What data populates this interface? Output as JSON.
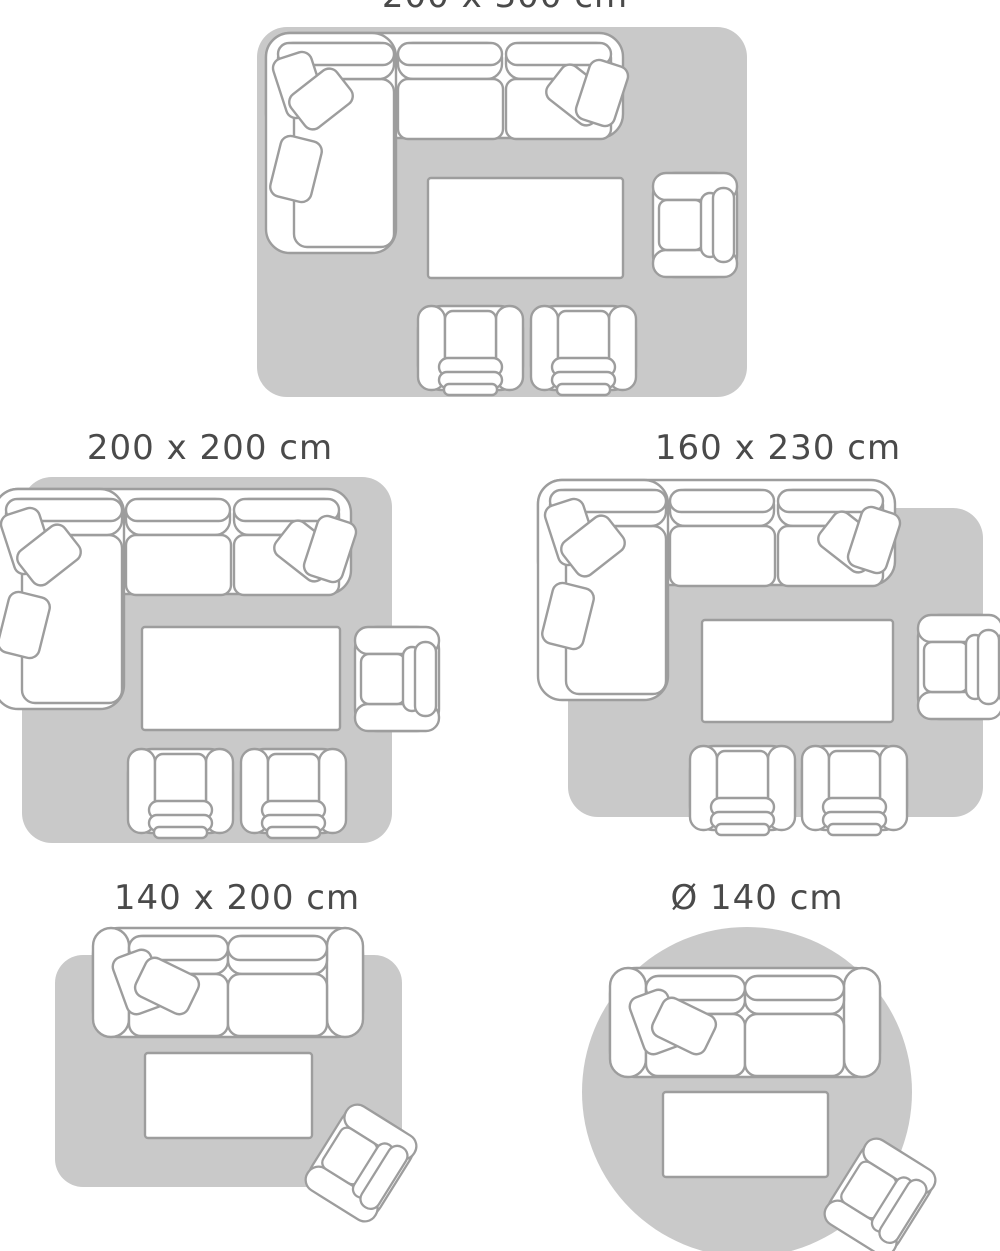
{
  "illustration": {
    "type": "rug-size-guide",
    "description": "Top-view living room furniture arrangements shown on five rug sizes"
  },
  "colors": {
    "background": "#ffffff",
    "rug": "#c9c9c9",
    "outline": "#9d9d9d",
    "furniture_fill": "#ffffff",
    "title": "#4a4a4a"
  },
  "layouts": [
    {
      "id": "200x300",
      "label": "200 x 300 cm",
      "rug_shape": "rectangle",
      "furniture": [
        "sectional-sofa",
        "throw-pillows",
        "coffee-table",
        "armchair",
        "club-chair",
        "club-chair"
      ]
    },
    {
      "id": "200x200",
      "label": "200 x 200 cm",
      "rug_shape": "rectangle",
      "furniture": [
        "sectional-sofa",
        "throw-pillows",
        "coffee-table",
        "armchair",
        "club-chair",
        "club-chair"
      ]
    },
    {
      "id": "160x230",
      "label": "160 x 230 cm",
      "rug_shape": "rectangle",
      "furniture": [
        "sectional-sofa",
        "throw-pillows",
        "coffee-table",
        "armchair",
        "club-chair",
        "club-chair"
      ]
    },
    {
      "id": "140x200",
      "label": "140 x 200 cm",
      "rug_shape": "rectangle",
      "furniture": [
        "two-seat-sofa",
        "throw-pillows",
        "coffee-table",
        "armchair"
      ]
    },
    {
      "id": "diameter-140",
      "label": "Ø 140 cm",
      "rug_shape": "circle",
      "furniture": [
        "two-seat-sofa",
        "throw-pillows",
        "coffee-table",
        "armchair"
      ]
    }
  ]
}
